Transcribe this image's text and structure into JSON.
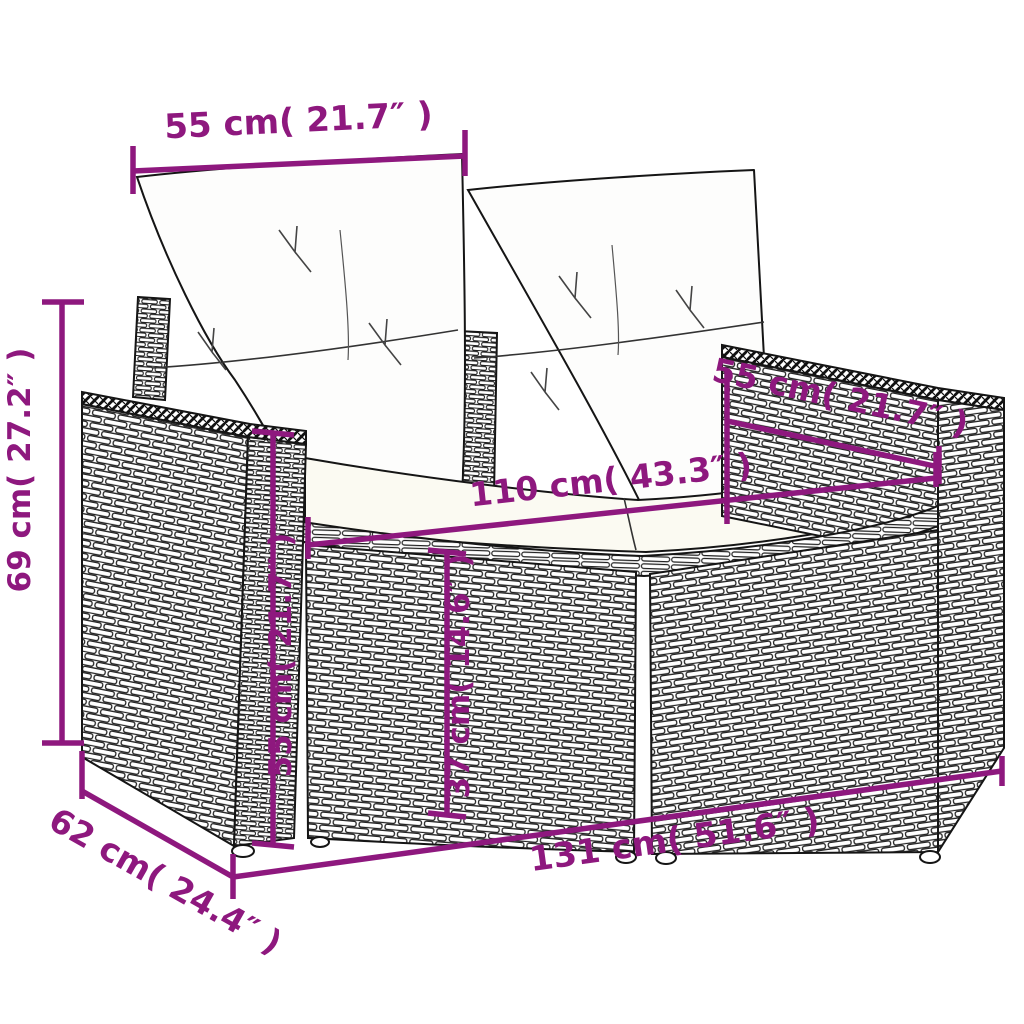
{
  "diagram": {
    "subject": "poly-rattan-garden-loveseat-with-cushions-dimension-drawing",
    "style": {
      "annotation_color": "#8E187E",
      "outline_color": "#151515",
      "cushion_fill": "#fdfdfc",
      "seat_fill": "#fbfaf2"
    },
    "dims": {
      "back_width": {
        "label": "55 cm( 21.7″ )"
      },
      "overall_height": {
        "label": "69 cm( 27.2″ )"
      },
      "arm_height": {
        "label": "55 cm( 21.7″ )"
      },
      "seat_height": {
        "label": "37 cm( 14.6″ )"
      },
      "arm_depth": {
        "label": "55 cm( 21.7″ )"
      },
      "seat_width": {
        "label": "110 cm( 43.3″ )"
      },
      "overall_width": {
        "label": "131 cm( 51.6″ )"
      },
      "overall_depth": {
        "label": "62 cm( 24.4″ )"
      }
    }
  }
}
